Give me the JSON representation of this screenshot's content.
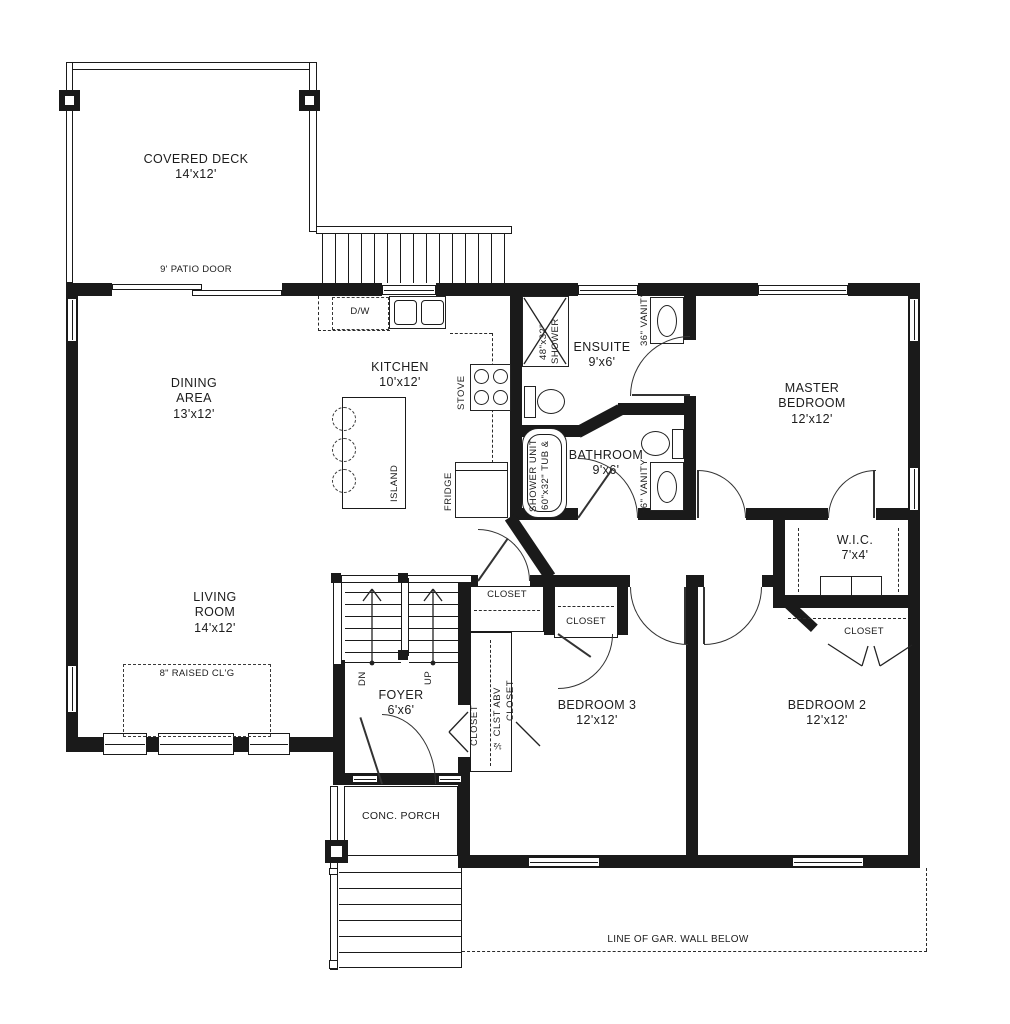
{
  "plan": {
    "colors": {
      "ink": "#1a1a1a",
      "paper": "#ffffff"
    },
    "deck": {
      "name": "COVERED DECK",
      "size": "14'x12'"
    },
    "patio_door": "9' PATIO DOOR",
    "dining": {
      "l1": "DINING",
      "l2": "AREA",
      "size": "13'x12'"
    },
    "kitchen": {
      "l1": "KITCHEN",
      "size": "10'x12'"
    },
    "living": {
      "l1": "LIVING",
      "l2": "ROOM",
      "size": "14'x12'"
    },
    "raised_ceiling": "8\" RAISED CL'G",
    "ensuite": {
      "l1": "ENSUITE",
      "size": "9'x6'"
    },
    "bathroom": {
      "l1": "BATHROOM",
      "size": "9'x6'"
    },
    "master": {
      "l1": "MASTER",
      "l2": "BEDROOM",
      "size": "12'x12'"
    },
    "wic": {
      "l1": "W.I.C.",
      "size": "7'x4'"
    },
    "foyer": {
      "l1": "FOYER",
      "size": "6'x6'"
    },
    "bedroom3": {
      "l1": "BEDROOM 3",
      "size": "12'x12'"
    },
    "bedroom2": {
      "l1": "BEDROOM 2",
      "size": "12'x12'"
    },
    "porch": "CONC. PORCH",
    "stairs": {
      "down": "DN",
      "up": "UP"
    },
    "fixtures": {
      "dishwasher": "D/W",
      "stove": "STOVE",
      "fridge": "FRIDGE",
      "island": "ISLAND",
      "shower_size": "48\"x32\"",
      "shower": "SHOWER",
      "tub_l1": "SHOWER UNIT",
      "tub_l2": "60\"x32\" TUB &",
      "vanity_ensuite": "36\" VANITY",
      "vanity_bath": "36\" VANITY"
    },
    "closets": {
      "hall": "CLOSET",
      "bed3": "CLOSET",
      "foyer": "CLOSET",
      "half": "½ CLST ABV",
      "bed3_side": "CLOSET",
      "bed2": "CLOSET"
    },
    "notes": {
      "gar_wall": "LINE OF GAR. WALL BELOW"
    }
  }
}
